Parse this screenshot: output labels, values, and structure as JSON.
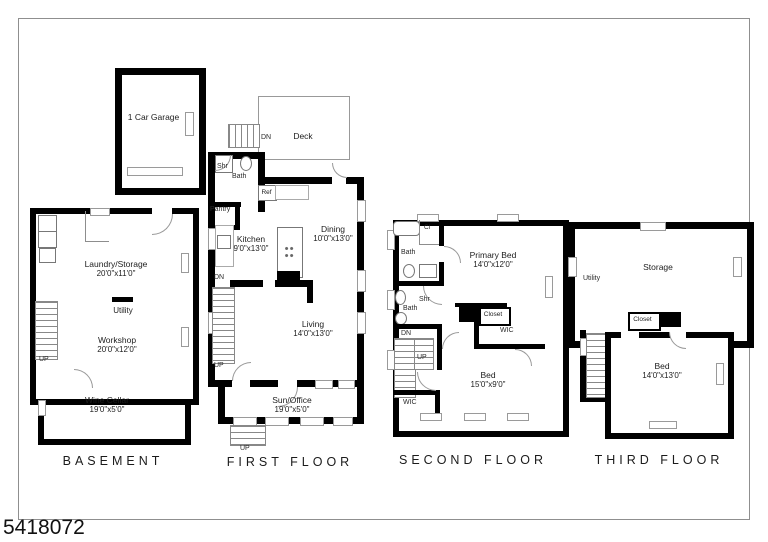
{
  "photo_id": "5418072",
  "titles": {
    "basement": "BASEMENT",
    "first": "FIRST FLOOR",
    "second": "SECOND FLOOR",
    "third": "THIRD FLOOR"
  },
  "basement": {
    "laundry": {
      "name": "Laundry/Storage",
      "dims": "20'0\"x11'0\""
    },
    "utility": "Utility",
    "workshop": {
      "name": "Workshop",
      "dims": "20'0\"x12'0\""
    },
    "wine": {
      "name": "Wine Cellar",
      "dims": "19'0\"x5'0\""
    },
    "up": "UP"
  },
  "first": {
    "garage": "1 Car Garage",
    "deck": "Deck",
    "deck_dn": "DN",
    "shr": "Shr",
    "bath": "Bath",
    "pantry": "Pantry",
    "ref": "Ref",
    "kitchen": {
      "name": "Kitchen",
      "dims": "9'0\"x13'0\""
    },
    "dining": {
      "name": "Dining",
      "dims": "10'0\"x13'0\""
    },
    "living": {
      "name": "Living",
      "dims": "14'0\"x13'0\""
    },
    "sun": {
      "name": "Sun/Office",
      "dims": "19'0\"x5'0\""
    },
    "dn": "DN",
    "up": "UP",
    "entry_up": "UP"
  },
  "second": {
    "bath_top": "Bath",
    "cl": "Cl",
    "primary": {
      "name": "Primary Bed",
      "dims": "14'0\"x12'0\""
    },
    "bath_mid": "Bath",
    "shr": "Shr",
    "dn": "DN",
    "up": "UP",
    "closet": "Closet",
    "wic_a": "WIC",
    "wic_b": "WIC",
    "bed": {
      "name": "Bed",
      "dims": "15'0\"x9'0\""
    }
  },
  "third": {
    "utility": "Utility",
    "storage": "Storage",
    "closet": "Closet",
    "dn": "DN",
    "bed": {
      "name": "Bed",
      "dims": "14'0\"x13'0\""
    }
  },
  "colors": {
    "wall": "#000000",
    "frame_line": "#8f8f8f",
    "text": "#1b1b1b"
  }
}
